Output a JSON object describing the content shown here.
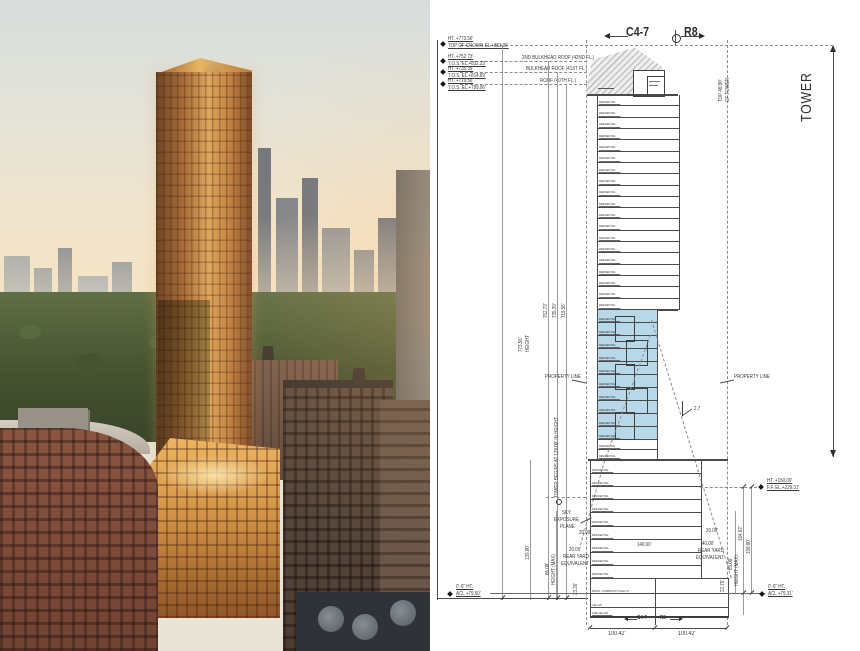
{
  "photo": {
    "colors": {
      "sky_top": "#d7dddc",
      "sky_horizon": "#f4e2c2",
      "park_green": "#45522f",
      "tower_gold": "#c98d4d",
      "brick_red": "#7c4c3b",
      "dark_brown": "#52433a"
    }
  },
  "drawing": {
    "header": {
      "left_district": "C4-7",
      "right_district": "R8"
    },
    "tower_bracket_label": "TOWER",
    "top_of_tower_dim": {
      "line1": "TOP 40.00'",
      "line2": "OF TOWER"
    },
    "callouts": [
      {
        "ht": "HT. +773.56'",
        "el": "TOP OF CROWN EL.+853.06'"
      },
      {
        "ht": "HT. +752.73'",
        "el": "T.O.S. EL.+832.23'"
      },
      {
        "ht": "HT. +735.39'",
        "el": "T.O.S. EL.+814.89'"
      },
      {
        "ht": "HT. +719.56'",
        "el": "T.O.S. EL.+799.06'"
      }
    ],
    "roof_labels": [
      "2ND BULKHEAD ROOF (42ND FL.)",
      "BULKHEAD ROOF (41ST FL.)",
      "ROOF (40TH FL.)"
    ],
    "height_dims": {
      "overall": "773.56'",
      "overall_label": "HEIGHT",
      "d2": "752.73'",
      "d3": "735.39'",
      "d4": "719.56'"
    },
    "property_line_left": "PROPERTY LINE",
    "property_line_right": "PROPERTY LINE",
    "tower_begins_note": "TOWER BEGINS AT 139.00' IN HEIGHT",
    "sky_exposure_plane": {
      "line1": "SKY",
      "line2": "EXPOSURE",
      "line3": "PLANE"
    },
    "slope_ratio": "2.7",
    "left_dims": {
      "d139": "139.00'",
      "d85": "85.00'",
      "height_max": "HEIGHT (MAX)",
      "d2326": "23.26'",
      "d20a": "20.00'",
      "d20b": "20.00'",
      "rear_yard": "REAR YARD",
      "equivalent": "EQUIVALENT"
    },
    "right_dims": {
      "d16492": "164.92'",
      "d150": "150.00'",
      "d85": "85.00'",
      "height_max": "HEIGHT (MAX)",
      "d2275": "22.75'",
      "d20": "20.00'",
      "d40": "40.00'",
      "rear_yard": "REAR YARD",
      "equivalent": "EQUIVALENT"
    },
    "right_callout": {
      "ht": "HT. +150.00'",
      "el": "F.F. EL.+229.31'"
    },
    "grade_callout_left": {
      "ht": "0'-0\" HT.",
      "el": "ACL +79.50'"
    },
    "grade_callout_right": {
      "ht": "0'-0\" HT.",
      "el": "ACL +79.31'"
    },
    "podium_width_dim": "140.00'",
    "bottom_dims": {
      "left": "100.42'",
      "right": "100.42'",
      "boundary_left": "C4-7",
      "boundary_right": "R8"
    },
    "base_rows": [
      "RETAIL, COMMUNITY FACILITY",
      "CELLAR",
      "SUB-CELLAR"
    ],
    "floors": {
      "label": "RESIDENTIAL",
      "upper_count": 19,
      "blue_count": 10,
      "lower_count": 2,
      "podium_count": 9
    },
    "colors": {
      "blue_zone": "#b7d8e9",
      "hatch_gray": "#d9d9d9",
      "line": "#3c3c3c"
    }
  }
}
